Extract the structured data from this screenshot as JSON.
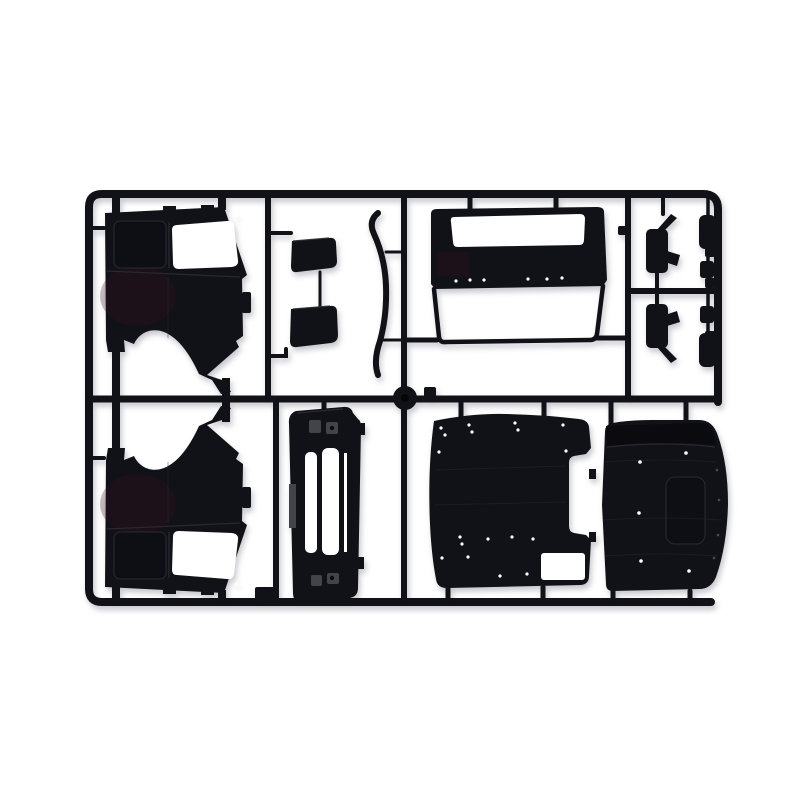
{
  "scene": {
    "description": "Photograph of a black injection-molded plastic model kit sprue containing truck cab body parts on a white background"
  },
  "colors": {
    "bg": "#ffffff",
    "ink": "#111118",
    "deep": "#0a0a0f",
    "hl": "#2b2b36",
    "recess": "#0e0e15",
    "step": "#43434b",
    "tint": "#3a1318",
    "gate": "#060609",
    "edgedot": "#4a4a55"
  },
  "parts": [
    {
      "id": "sprue-frame",
      "label": "runner frame"
    },
    {
      "id": "cab-side-panel-left",
      "label": "cab side panel with door window and wheel arch"
    },
    {
      "id": "cab-side-panel-right",
      "label": "opposite cab side panel (mirrored)"
    },
    {
      "id": "windshield-frame-panel",
      "label": "cab front panel with windshield aperture"
    },
    {
      "id": "trim-strip",
      "label": "curved A-pillar trim strip"
    },
    {
      "id": "visor-bracket-upper",
      "label": "small bracket part"
    },
    {
      "id": "visor-bracket-lower",
      "label": "small bracket part"
    },
    {
      "id": "mirror-housing-upper",
      "label": "mirror housing with arm"
    },
    {
      "id": "mirror-housing-lower",
      "label": "mirror housing with arm"
    },
    {
      "id": "mirror-pill-parts",
      "label": "four small mirror bracket pieces"
    },
    {
      "id": "grille-panel",
      "label": "front grille panel with slots"
    },
    {
      "id": "floor-panel",
      "label": "cab floor panel with rivet holes"
    },
    {
      "id": "roof-panel",
      "label": "cab roof panel with sunroof recess"
    },
    {
      "id": "injection-gate",
      "label": "round injection gate disc"
    }
  ]
}
